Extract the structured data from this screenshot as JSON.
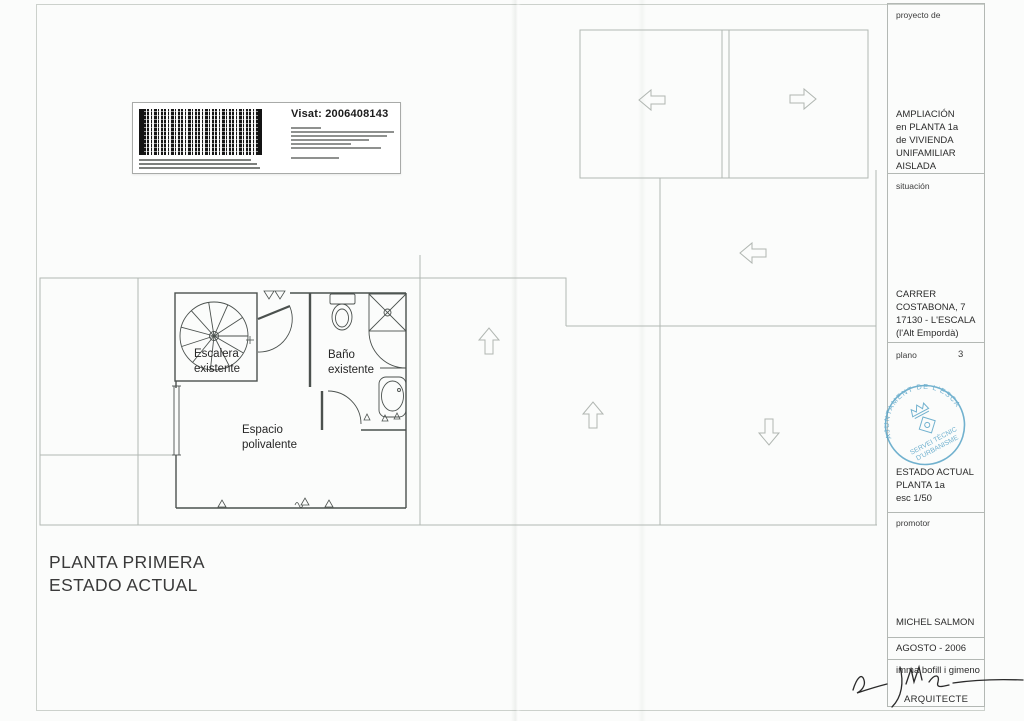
{
  "sheet": {
    "big_title": "PLANTA PRIMERA\nESTADO ACTUAL"
  },
  "visat_label": {
    "visat_text": "Visat: 2006408143"
  },
  "plan": {
    "room_labels": {
      "stairs": "Escalera\nexistente",
      "bath": "Baño\nexistente",
      "multi_space": "Espacio\npolivalente"
    }
  },
  "title_block": {
    "proyecto_label": "proyecto de",
    "proyecto_value": "AMPLIACIÓN\nen PLANTA 1a\nde VIVIENDA\nUNIFAMILIAR\nAISLADA",
    "situacion_label": "situación",
    "situacion_value": "CARRER\nCOSTABONA, 7\n17130 - L'ESCALA\n(l'Alt Empordà)",
    "plano_label": "plano",
    "plano_number": "3",
    "estado_value": "ESTADO ACTUAL\nPLANTA 1a\nesc 1/50",
    "promotor_label": "promotor",
    "promotor_value": "MICHEL SALMON",
    "date_value": "AGOSTO - 2006",
    "architect_name": "imma bofill i gimeno",
    "architect_title": "ARQUITECTE"
  },
  "stamp": {
    "ring_text": "AJUNTAMENT DE L'ESCALA",
    "line1": "SERVEI TÈCNIC",
    "line2": "D'URBANISME",
    "color": "#4f9fc4"
  },
  "colors": {
    "plan_light_line": "#b2b8b3",
    "plan_wall": "#4b514e",
    "sheet_border": "#ccd1cc",
    "stamp_blue": "#4f9fc4"
  }
}
